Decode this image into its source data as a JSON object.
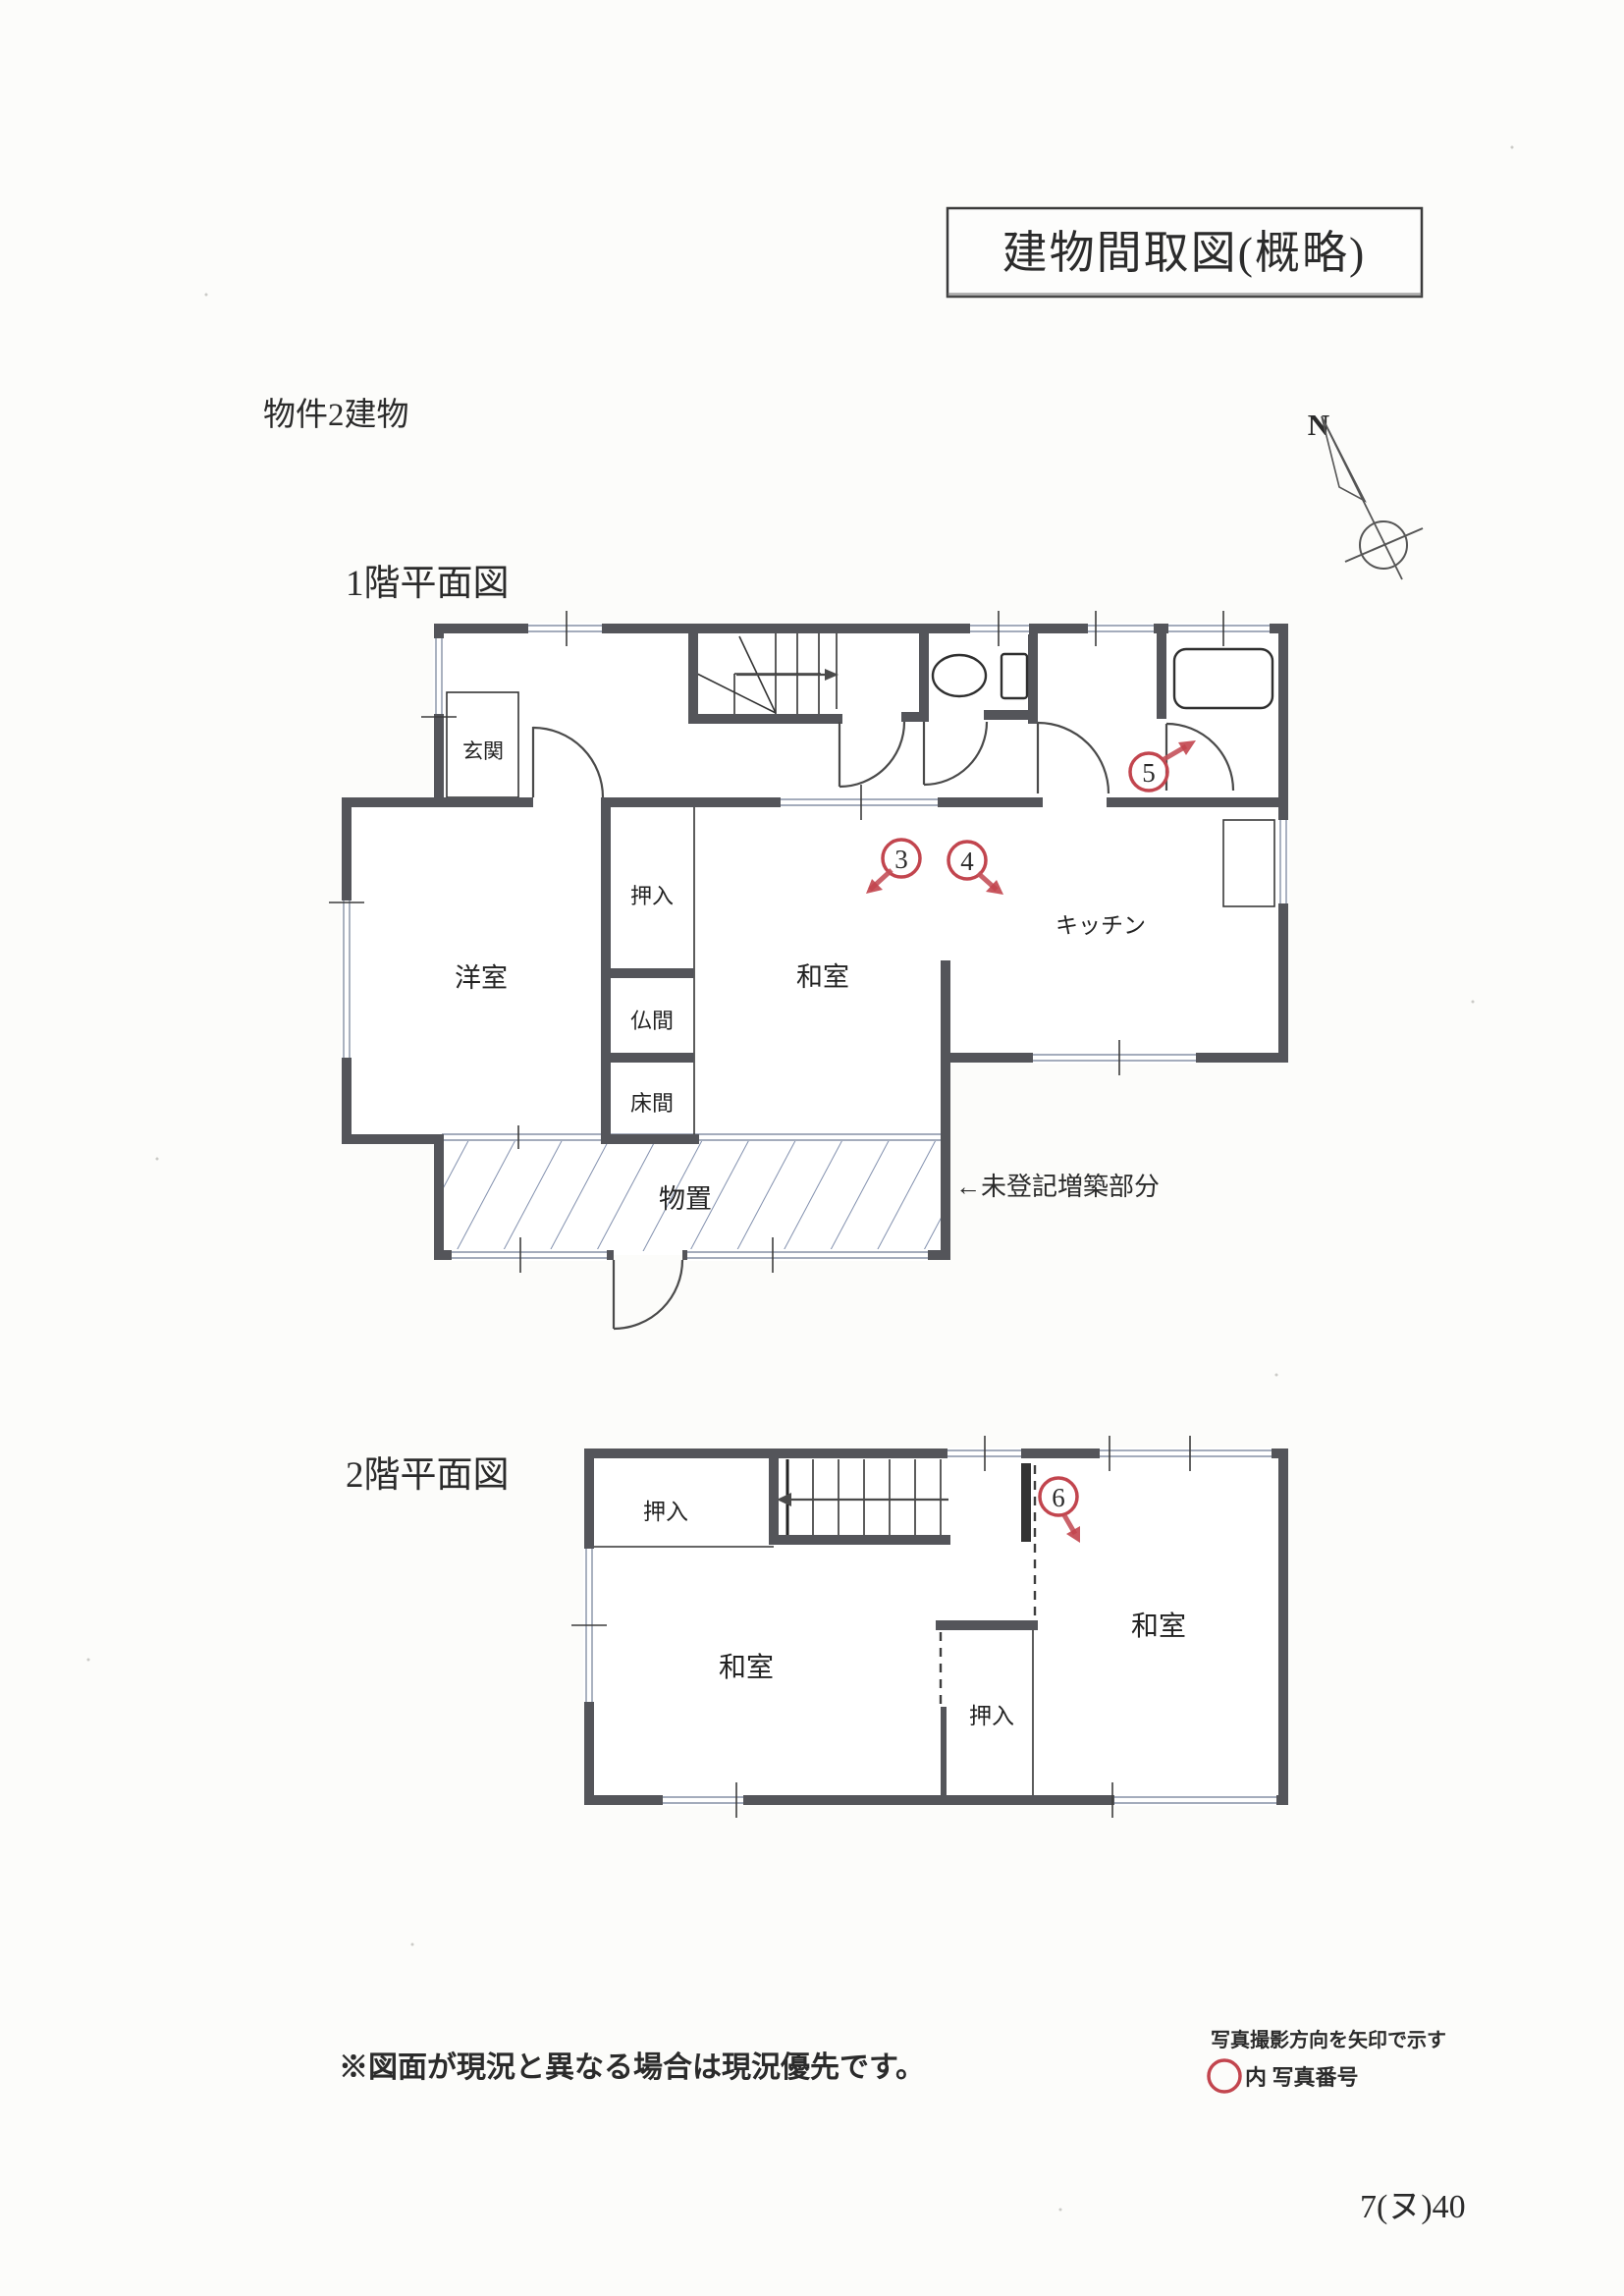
{
  "document": {
    "title": "建物間取図(概略)",
    "property": "物件2建物",
    "page_number": "7(ヌ)40"
  },
  "compass": {
    "north_label": "N"
  },
  "floor1": {
    "heading": "1階平面図",
    "rooms": {
      "genkan": "玄関",
      "youshitsu": "洋室",
      "oshiire": "押入",
      "butsuma": "仏間",
      "tokonoma": "床間",
      "washitsu": "和室",
      "kitchen": "キッチン",
      "monooki": "物置"
    },
    "annotation_unregistered": "←未登記増築部分"
  },
  "floor2": {
    "heading": "2階平面図",
    "rooms": {
      "oshiire_top": "押入",
      "washitsu_left": "和室",
      "washitsu_right": "和室",
      "oshiire_bottom": "押入"
    }
  },
  "photo_markers": {
    "m3": "3",
    "m4": "4",
    "m5": "5",
    "m6": "6"
  },
  "legend": {
    "direction_note": "写真撮影方向を矢印で示す",
    "number_note": "内 写真番号"
  },
  "footer": {
    "disclaimer": "※図面が現況と異なる場合は現況優先です。"
  },
  "colors": {
    "wall": "#54555a",
    "accent_red": "#c2454e",
    "annotation_blue": "#5d6c8e",
    "footer_blue": "#4a5878"
  }
}
